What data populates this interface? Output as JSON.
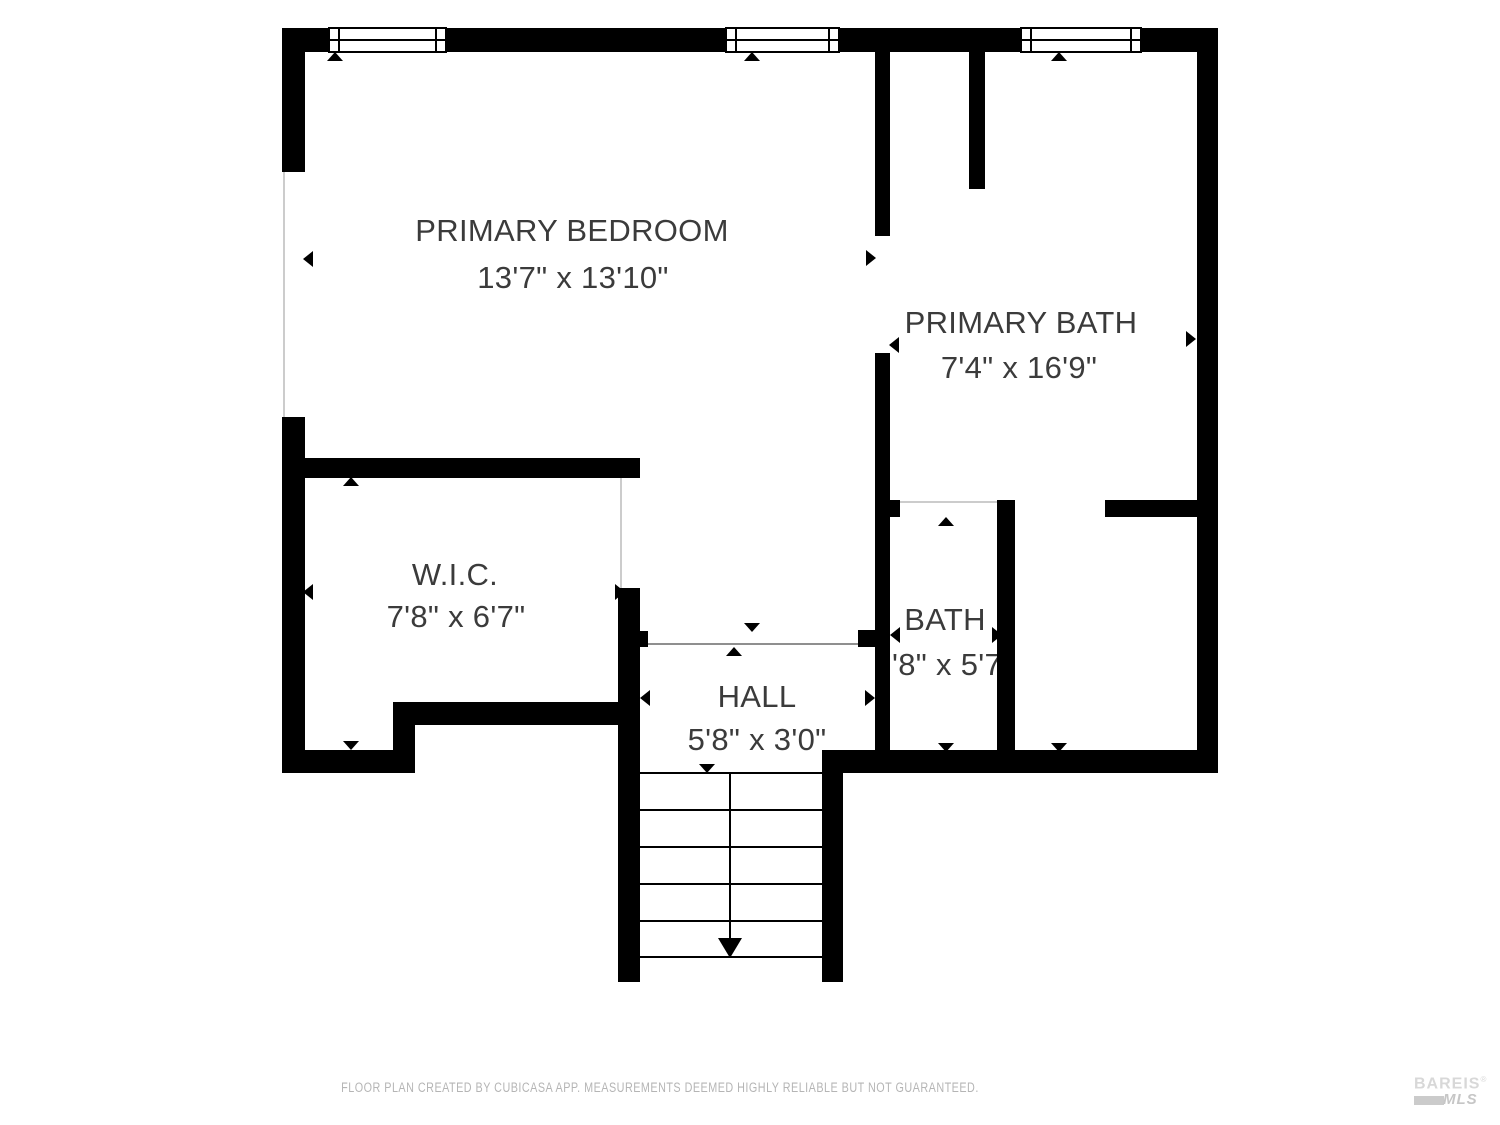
{
  "plan": {
    "rooms": [
      {
        "name": "PRIMARY BEDROOM",
        "dims": "13'7\" x 13'10\""
      },
      {
        "name": "PRIMARY BATH",
        "dims": "7'4\" x 16'9\""
      },
      {
        "name": "W.I.C.",
        "dims": "7'8\" x 6'7\""
      },
      {
        "name": "BATH",
        "dims": "'8\" x 5'7"
      },
      {
        "name": "HALL",
        "dims": "5'8\" x 3'0\""
      }
    ]
  },
  "footer": {
    "disclaimer": "FLOOR PLAN CREATED BY CUBICASA APP. MEASUREMENTS DEEMED HIGHLY RELIABLE BUT NOT GUARANTEED."
  },
  "logo": {
    "brand": "BAREIS",
    "registered": "®",
    "sub": "MLS"
  },
  "colors": {
    "wall": "#000000",
    "floor": "#ffffff",
    "label_text": "#3b3b3b",
    "opening_line": "#cccccc",
    "footer_text": "#b5b5b5",
    "logo_gray": "#d8d8d8"
  }
}
